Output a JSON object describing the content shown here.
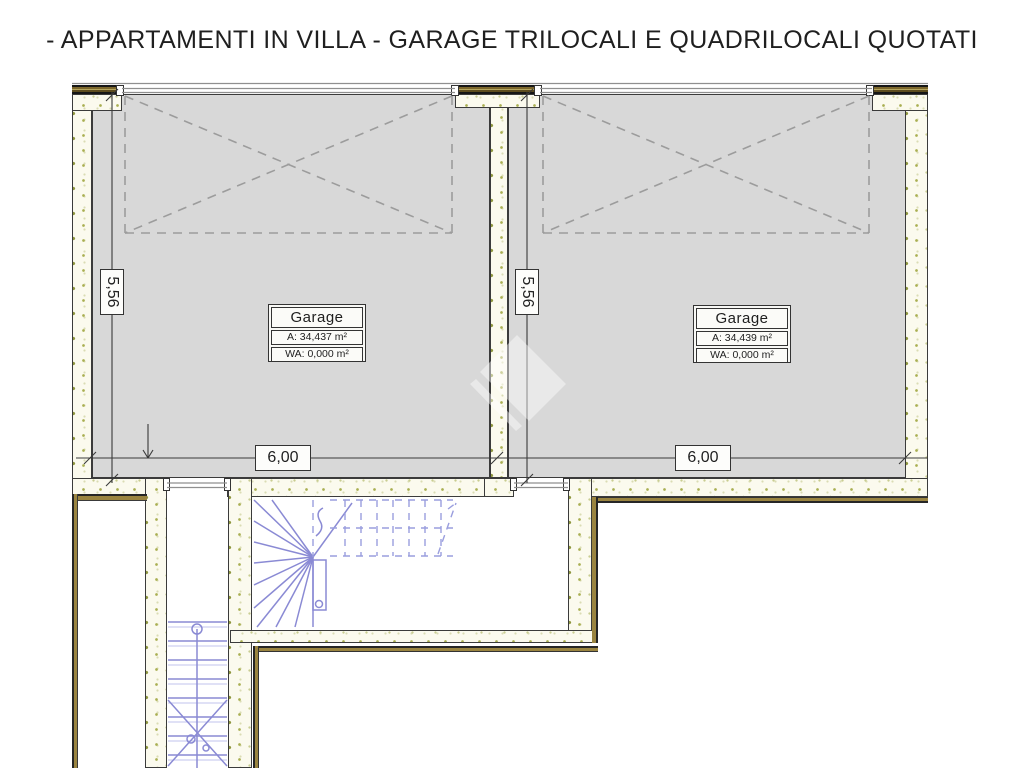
{
  "title": "- APPARTAMENTI IN VILLA - GARAGE TRILOCALI E QUADRILOCALI QUOTATI",
  "garage_left": {
    "name": "Garage",
    "area": "A:  34,437 m²",
    "wa": "WA: 0,000 m²"
  },
  "garage_right": {
    "name": "Garage",
    "area": "A:  34,439 m²",
    "wa": "WA: 0,000 m²"
  },
  "dims": {
    "depth_left": "5,56",
    "depth_right": "5,56",
    "width_left": "6,00",
    "width_right": "6,00"
  },
  "colors": {
    "floor": "#d8d8d8",
    "outline": "#3b3b3b",
    "accent": "#9a8440",
    "lintel": "#5d4c1e",
    "stair": "#8a8ad4",
    "dash": "#9c9c9c",
    "dim": "#3a3a3a",
    "wall": "#fbfaee"
  }
}
